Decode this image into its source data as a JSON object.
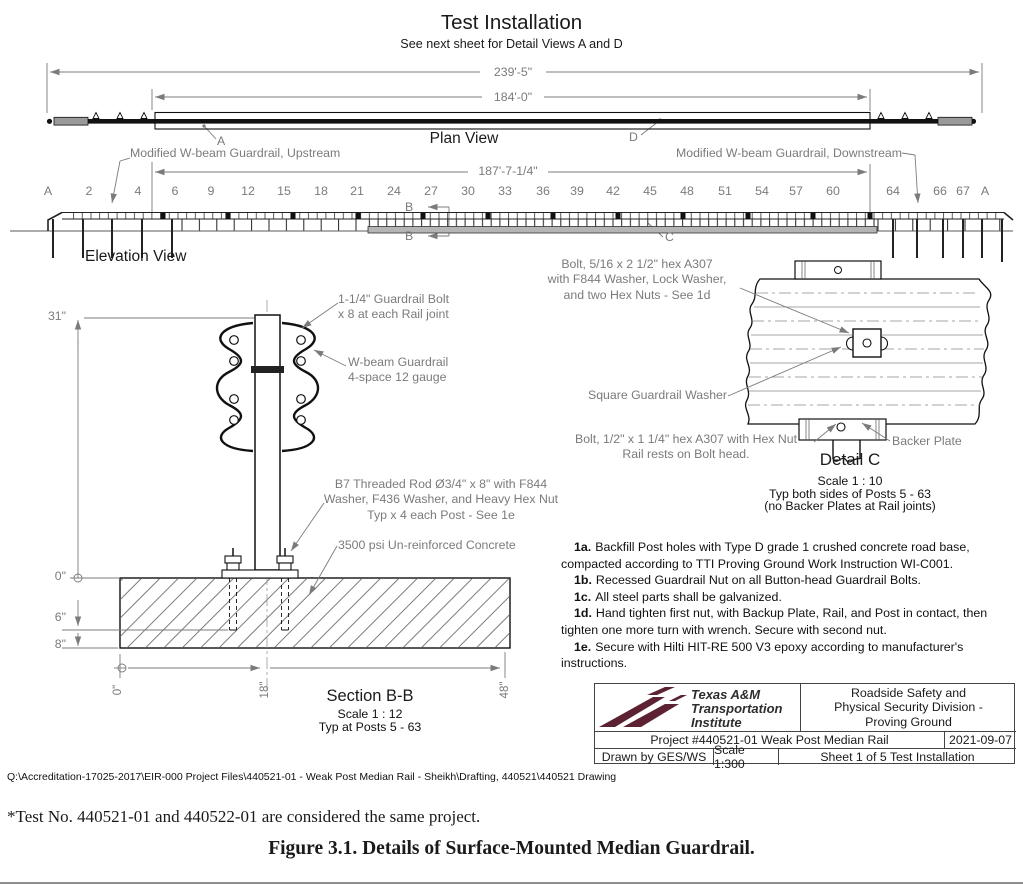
{
  "colors": {
    "annotation_gray": "#7b7b7b",
    "line_black": "#1a1a1a",
    "brand_maroon": "#5C2231",
    "concrete_gray": "#b5b5b5"
  },
  "drawing": {
    "title": "Test Installation",
    "subtitle": "See next sheet for Detail Views A and D",
    "plan": {
      "label": "Plan View",
      "dim_overall": "239'-5\"",
      "dim_rail": "184'-0\"",
      "callout_a": "A",
      "callout_d": "D"
    },
    "elevation": {
      "label": "Elevation View",
      "upstream": "Modified W-beam Guardrail, Upstream",
      "downstream": "Modified W-beam Guardrail, Downstream",
      "dim_span": "187'-7-1/4\"",
      "marker_b": "B",
      "callout_c": "C",
      "post_labels": [
        "A",
        "2",
        "4",
        "6",
        "9",
        "12",
        "15",
        "18",
        "21",
        "24",
        "27",
        "30",
        "33",
        "36",
        "39",
        "42",
        "45",
        "48",
        "51",
        "54",
        "57",
        "60",
        "64",
        "66",
        "67",
        "A"
      ]
    },
    "section_bb": {
      "title": "Section B-B",
      "scale": "Scale 1 : 12",
      "typ": "Typ at Posts 5 - 63",
      "dims": {
        "height": "31\"",
        "d0": "0\"",
        "d6": "6\"",
        "d8": "8\"",
        "b0": "0\"",
        "b18": "18\"",
        "b48": "48\""
      },
      "labels": {
        "rail_bolt": "1-1/4\" Guardrail Bolt\nx 8 at each Rail joint",
        "wbeam": "W-beam Guardrail\n4-space 12 gauge",
        "rod": "B7 Threaded Rod Ø3/4\" x 8\" with F844\nWasher, F436 Washer, and Heavy Hex Nut\nTyp x 4 each Post - See 1e",
        "concrete": "3500 psi Un-reinforced Concrete"
      }
    },
    "detail_c": {
      "title": "Detail C",
      "scale": "Scale 1 : 10",
      "typ": "Typ both sides of Posts 5 - 63",
      "note": "(no Backer Plates at Rail joints)",
      "labels": {
        "bolt_top": "Bolt, 5/16 x 2 1/2\" hex A307\nwith F844 Washer, Lock Washer,\nand two Hex Nuts - See 1d",
        "washer": "Square Guardrail Washer",
        "bolt_bottom": "Bolt, 1/2\" x 1 1/4\" hex A307 with Hex Nut\nRail rests on Bolt head.",
        "backer": "Backer Plate"
      }
    },
    "notes": [
      {
        "id": "1a.",
        "text": "Backfill Post holes with Type D grade 1 crushed concrete road base, compacted according to TTI Proving Ground Work Instruction WI-C001."
      },
      {
        "id": "1b.",
        "text": "Recessed Guardrail Nut on all Button-head Guardrail Bolts."
      },
      {
        "id": "1c.",
        "text": "All steel parts shall be galvanized."
      },
      {
        "id": "1d.",
        "text": "Hand tighten first nut, with Backup Plate, Rail, and Post in contact, then tighten one more turn with wrench. Secure with second nut."
      },
      {
        "id": "1e.",
        "text": "Secure with Hilti HIT-RE 500 V3 epoxy according to manufacturer's instructions."
      }
    ],
    "title_block": {
      "org_line1": "Texas A&M",
      "org_line2": "Transportation",
      "org_line3": "Institute",
      "division": "Roadside Safety and\nPhysical Security Division -\nProving Ground",
      "project": "Project #440521-01  Weak Post Median Rail",
      "date": "2021-09-07",
      "drawn_by": "Drawn by GES/WS",
      "scale": "Scale 1:300",
      "sheet": "Sheet 1 of 5  Test Installation"
    }
  },
  "page": {
    "file_path": "Q:\\Accreditation-17025-2017\\EIR-000 Project Files\\440521-01 - Weak Post Median Rail - Sheikh\\Drafting, 440521\\440521 Drawing",
    "footnote": "*Test No. 440521-01 and 440522-01 are considered the same project.",
    "caption": "Figure 3.1. Details of Surface-Mounted Median Guardrail."
  }
}
